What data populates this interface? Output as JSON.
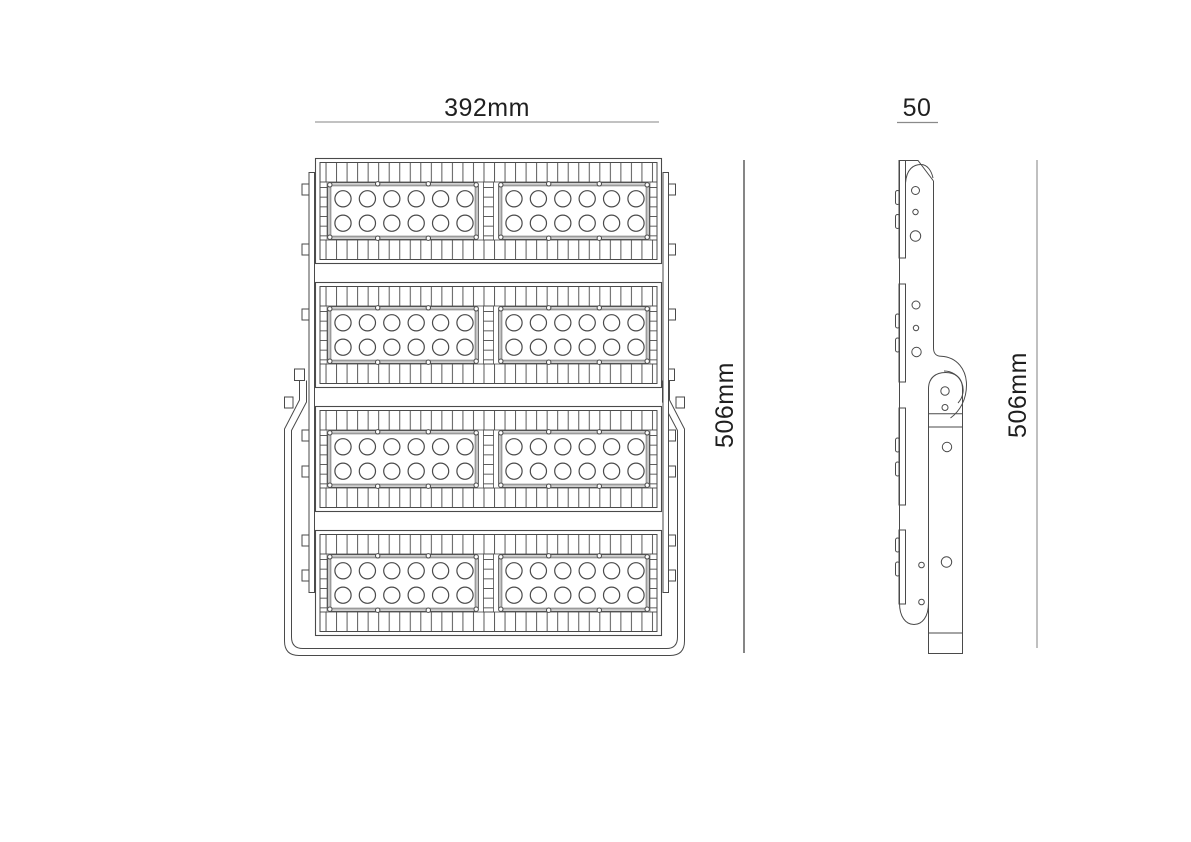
{
  "colors": {
    "background": "#ffffff",
    "drawing_line": "#4a4a4a",
    "dim_line_light": "#9e9e9e",
    "dim_line_dark": "#454545",
    "text": "#1f1f1f"
  },
  "dimensions": {
    "front_width": {
      "label": "392mm"
    },
    "side_width": {
      "label": "50"
    },
    "front_height": {
      "label": "506mm"
    },
    "side_height": {
      "label": "506mm"
    }
  },
  "drawing": {
    "kind": "technical-orthographic-drawing",
    "front_view": {
      "module_rows": 4,
      "panels_per_row": 2,
      "led_columns_per_panel": 6,
      "led_rows_per_panel": 2,
      "total_leds": 96
    },
    "side_view": {
      "has_mounting_bracket": true,
      "module_segments": 4
    }
  }
}
